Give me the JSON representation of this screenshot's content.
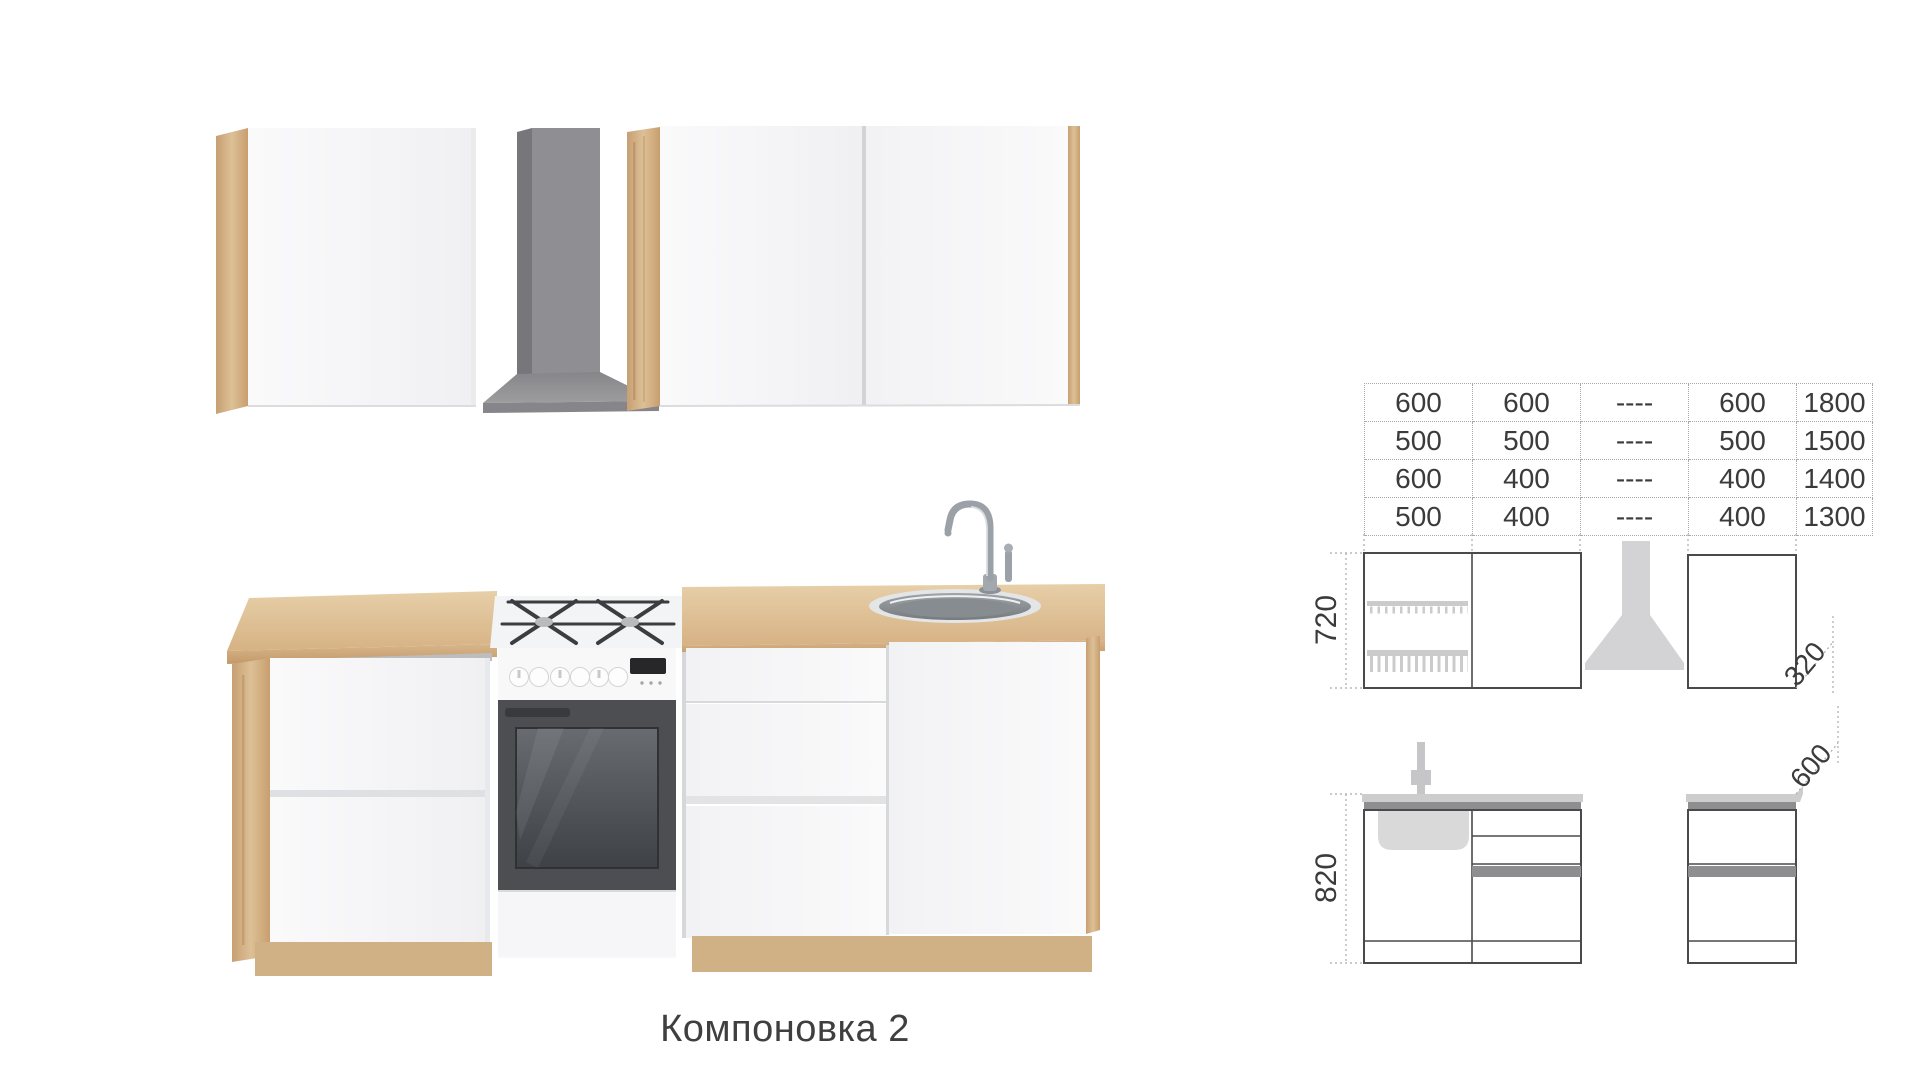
{
  "title": "Компоновка 2",
  "dimension_table": {
    "rows": [
      [
        "600",
        "600",
        "----",
        "600",
        "1800"
      ],
      [
        "500",
        "500",
        "----",
        "500",
        "1500"
      ],
      [
        "600",
        "400",
        "----",
        "400",
        "1400"
      ],
      [
        "500",
        "400",
        "----",
        "400",
        "1300"
      ]
    ]
  },
  "upper_elevation": {
    "height_mm": "720",
    "depth_mm": "320"
  },
  "lower_elevation": {
    "height_mm": "820",
    "depth_mm": "600"
  },
  "icons": {
    "hood": "range-hood-silhouette",
    "faucet": "faucet-symbol",
    "sink": "sink-basin-symbol",
    "dish_rack": "plate-rack-symbol"
  },
  "colors": {
    "wood": "#d7b88d",
    "wood_dark": "#c59e72",
    "cabinet_white": "#f6f6f8",
    "hood_gray": "#8f8f93",
    "drawing_line": "#4a4a4a",
    "drawing_gray": "#8e8e90",
    "drawing_light_gray": "#d2d2d4",
    "text": "#3b3b3b"
  }
}
